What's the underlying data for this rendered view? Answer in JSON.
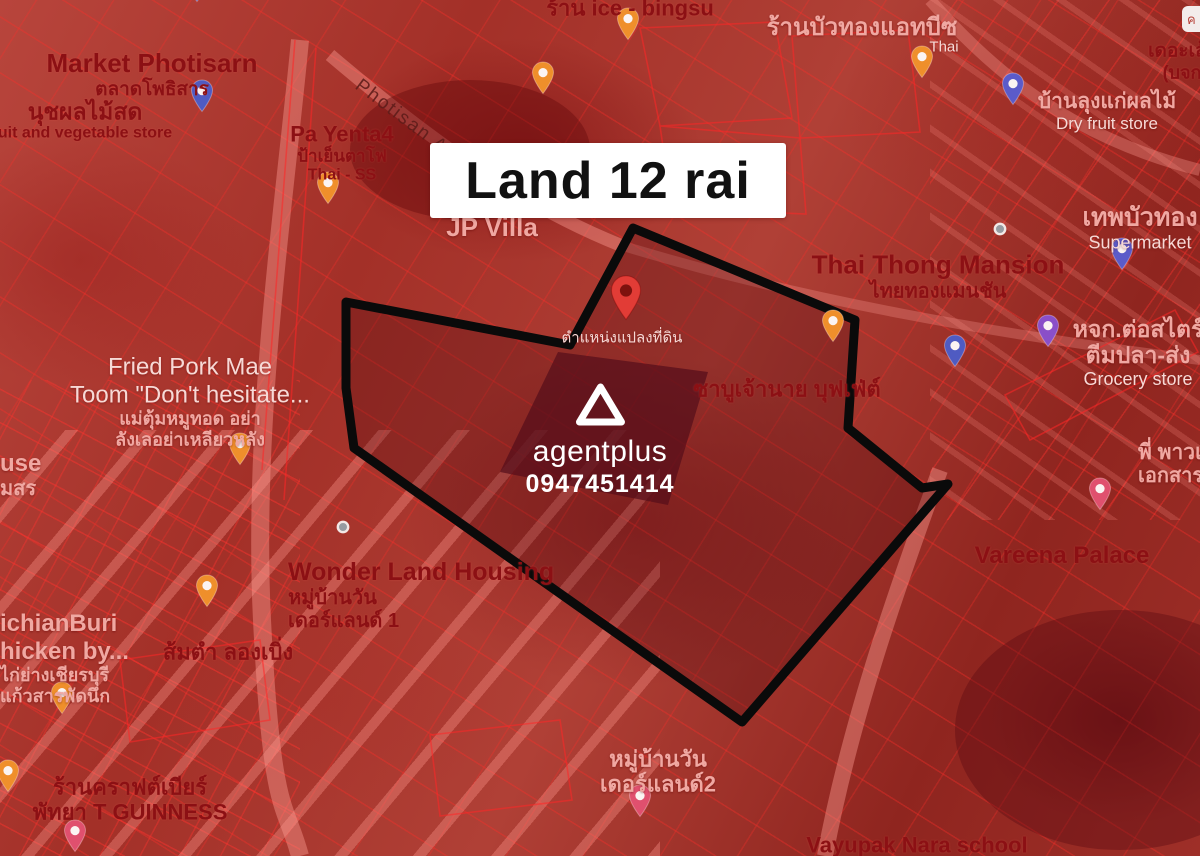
{
  "title_card": {
    "text": "Land 12 rai"
  },
  "watermark": {
    "brand": "agentplus",
    "phone": "0947451414",
    "logo": "agentplus-triangle-logo"
  },
  "corner_chip": {
    "text": "ค"
  },
  "land_plot": {
    "polygon_points": "633,228 855,320 848,428 922,488 948,484 742,722 354,448 346,388 346,302 570,345",
    "boundary_color": "#0a0a0a",
    "pin": {
      "x": 626,
      "y": 322,
      "color": "#e23c36"
    }
  },
  "colors": {
    "map_tint": "#a33028",
    "parcel_line": "#ff2a2a",
    "card_bg": "#ffffff",
    "card_text": "#111111",
    "label_dark": "#8c1014",
    "label_light": "#f0a8a2",
    "pin_orange": "#ef8f2b",
    "pin_blue": "#4f5bc2",
    "pin_violet": "#8a4fc8",
    "pin_pink": "#e0506e",
    "pin_red": "#e23c36"
  },
  "places": [
    {
      "id": "market-photisarn",
      "x": 152,
      "y": 75,
      "align": "center",
      "lines": [
        {
          "text": "Market Photisarn",
          "size": 26,
          "style": "dark"
        },
        {
          "text": "ตลาดโพธิสาร",
          "size": 19,
          "style": "dark"
        }
      ]
    },
    {
      "id": "nuch-fruit-store",
      "x": 85,
      "y": 121,
      "align": "center",
      "lines": [
        {
          "text": "นุชผลไม้สด",
          "size": 23,
          "style": "dark"
        },
        {
          "text": "uit and vegetable store",
          "size": 16,
          "style": "dark"
        }
      ]
    },
    {
      "id": "ice-bingsu",
      "x": 630,
      "y": 8,
      "align": "center",
      "lines": [
        {
          "text": "ร้าน ice - bingsu",
          "size": 22,
          "style": "dark"
        }
      ]
    },
    {
      "id": "buathong-at-b",
      "x": 862,
      "y": 28,
      "align": "center",
      "lines": [
        {
          "text": "ร้านบัวทองแอทบีซ",
          "size": 24,
          "style": "light"
        }
      ]
    },
    {
      "id": "buathong-thai",
      "x": 944,
      "y": 47,
      "align": "center",
      "lines": [
        {
          "text": "Thai",
          "size": 15,
          "style": "white"
        }
      ]
    },
    {
      "id": "the-leng",
      "x": 1182,
      "y": 62,
      "align": "center",
      "lines": [
        {
          "text": "เดอะเล้ง",
          "size": 19,
          "style": "dark"
        },
        {
          "text": "(บจก",
          "size": 18,
          "style": "dark"
        }
      ]
    },
    {
      "id": "dry-fruit-store",
      "x": 1107,
      "y": 112,
      "align": "center",
      "lines": [
        {
          "text": "บ้านลุงแก่ผลไม้",
          "size": 21,
          "style": "light"
        },
        {
          "text": "Dry fruit store",
          "size": 17,
          "style": "white"
        }
      ]
    },
    {
      "id": "pa-yenta4",
      "x": 342,
      "y": 153,
      "align": "center",
      "lines": [
        {
          "text": "Pa Yenta4",
          "size": 22,
          "style": "dark"
        },
        {
          "text": "ป้าเย็นตาโฟ",
          "size": 17,
          "style": "dark"
        },
        {
          "text": "Thai - SS",
          "size": 16,
          "style": "dark"
        }
      ]
    },
    {
      "id": "photisan-alley",
      "x": 416,
      "y": 128,
      "align": "center",
      "rotate": 37,
      "lines": [
        {
          "text": "Photisan Alley",
          "size": 19,
          "style": "street"
        }
      ]
    },
    {
      "id": "jp-villa",
      "x": 492,
      "y": 228,
      "align": "center",
      "lines": [
        {
          "text": "JP Villa",
          "size": 26,
          "style": "light"
        }
      ]
    },
    {
      "id": "thai-thong-mansion",
      "x": 938,
      "y": 277,
      "align": "center",
      "lines": [
        {
          "text": "Thai Thong Mansion",
          "size": 26,
          "style": "dark"
        },
        {
          "text": "ไทยทองแมนชัน",
          "size": 20,
          "style": "dark"
        }
      ]
    },
    {
      "id": "thep-buathong",
      "x": 1140,
      "y": 228,
      "align": "center",
      "lines": [
        {
          "text": "เทพบัวทอง",
          "size": 25,
          "style": "light"
        },
        {
          "text": "Supermarket",
          "size": 18,
          "style": "white"
        }
      ]
    },
    {
      "id": "grocery-store",
      "x": 1138,
      "y": 353,
      "align": "center",
      "lines": [
        {
          "text": "หจก.ต่อสไตร์",
          "size": 23,
          "style": "light"
        },
        {
          "text": "ตีมปลา-ส่ง",
          "size": 23,
          "style": "light"
        },
        {
          "text": "Grocery store",
          "size": 18,
          "style": "white"
        }
      ]
    },
    {
      "id": "fried-pork-mae-toom",
      "x": 190,
      "y": 402,
      "align": "center",
      "lines": [
        {
          "text": "Fried Pork Mae",
          "size": 24,
          "style": "white"
        },
        {
          "text": "Toom \"Don't hesitate...",
          "size": 24,
          "style": "white"
        },
        {
          "text": "แม่ตุ้มหมูทอด อย่า",
          "size": 18,
          "style": "light"
        },
        {
          "text": "ลังเลอย่าเหลียวหลัง",
          "size": 18,
          "style": "light"
        }
      ]
    },
    {
      "id": "shabu-chaonai-buffet",
      "x": 787,
      "y": 389,
      "align": "center",
      "lines": [
        {
          "text": "ซาบูเจ้านาย บุฟเฟ่ต์",
          "size": 22,
          "style": "dark"
        }
      ]
    },
    {
      "id": "plot-position-label",
      "x": 622,
      "y": 338,
      "align": "center",
      "lines": [
        {
          "text": "ตำแหน่งแปลงที่ดิน",
          "size": 15,
          "style": "white"
        }
      ]
    },
    {
      "id": "use-msr",
      "x": 0,
      "y": 450,
      "align": "left",
      "lines": [
        {
          "text": "use",
          "size": 24,
          "style": "light"
        },
        {
          "text": "มสร",
          "size": 20,
          "style": "light"
        }
      ]
    },
    {
      "id": "wonder-land-housing",
      "x": 288,
      "y": 558,
      "align": "left",
      "lines": [
        {
          "text": "Wonder Land Housing",
          "size": 25,
          "style": "dark"
        },
        {
          "text": "หมู่บ้านวัน",
          "size": 20,
          "style": "dark"
        },
        {
          "text": "เดอร์แลนด์ 1",
          "size": 20,
          "style": "dark"
        }
      ]
    },
    {
      "id": "somtam-longboeng",
      "x": 228,
      "y": 652,
      "align": "center",
      "lines": [
        {
          "text": "ส้มตำ ลองเบิ่ง",
          "size": 22,
          "style": "dark"
        }
      ]
    },
    {
      "id": "wichianburi-chicken",
      "x": 0,
      "y": 610,
      "align": "left",
      "lines": [
        {
          "text": "ichianBuri",
          "size": 24,
          "style": "light"
        },
        {
          "text": "hicken by...",
          "size": 24,
          "style": "light"
        },
        {
          "text": "ไก่ย่างเชียรบุรี",
          "size": 18,
          "style": "light"
        },
        {
          "text": "แก้วสารพัดนึก",
          "size": 18,
          "style": "light"
        }
      ]
    },
    {
      "id": "p-power-documents",
      "x": 1138,
      "y": 441,
      "align": "left",
      "lines": [
        {
          "text": "พี่ พาวเ",
          "size": 21,
          "style": "light"
        },
        {
          "text": "เอกสาร",
          "size": 20,
          "style": "light"
        }
      ]
    },
    {
      "id": "vareena-palace",
      "x": 1062,
      "y": 556,
      "align": "center",
      "lines": [
        {
          "text": "Vareena Palace",
          "size": 24,
          "style": "dark"
        }
      ]
    },
    {
      "id": "wonderland2",
      "x": 658,
      "y": 772,
      "align": "center",
      "lines": [
        {
          "text": "หมู่บ้านวัน",
          "size": 22,
          "style": "light"
        },
        {
          "text": "เดอร์แลนด์2",
          "size": 22,
          "style": "light"
        }
      ]
    },
    {
      "id": "craft-beer-guinness",
      "x": 130,
      "y": 800,
      "align": "center",
      "lines": [
        {
          "text": "ร้านคราฟต์เบียร์",
          "size": 22,
          "style": "dark"
        },
        {
          "text": "พัทยา T GUINNESS",
          "size": 22,
          "style": "dark"
        }
      ]
    },
    {
      "id": "vayupak-nara-school",
      "x": 917,
      "y": 845,
      "align": "center",
      "lines": [
        {
          "text": "Vayupak Nara school",
          "size": 22,
          "style": "dark"
        }
      ]
    }
  ],
  "pins": [
    {
      "id": "market-top",
      "kind": "bag",
      "color": "#4f5bc2",
      "x": 197,
      "y": 2
    },
    {
      "id": "nuch-store",
      "kind": "bag",
      "color": "#4f5bc2",
      "x": 202,
      "y": 112
    },
    {
      "id": "ice-bingsu",
      "kind": "food",
      "color": "#ef8f2b",
      "x": 628,
      "y": 40
    },
    {
      "id": "cafe",
      "kind": "food",
      "color": "#ef8f2b",
      "x": 543,
      "y": 94
    },
    {
      "id": "buathong",
      "kind": "food",
      "color": "#ef8f2b",
      "x": 922,
      "y": 78
    },
    {
      "id": "dry-fruit",
      "kind": "bag",
      "color": "#5b5bc9",
      "x": 1013,
      "y": 105
    },
    {
      "id": "pa-yenta",
      "kind": "food",
      "color": "#ef8f2b",
      "x": 328,
      "y": 204
    },
    {
      "id": "thai-thong",
      "kind": "dot",
      "color": "#969ba1",
      "x": 1000,
      "y": 229
    },
    {
      "id": "supermarket",
      "kind": "bag",
      "color": "#5b5bc9",
      "x": 1122,
      "y": 270
    },
    {
      "id": "plot-food",
      "kind": "food",
      "color": "#ef8f2b",
      "x": 833,
      "y": 342
    },
    {
      "id": "grocery-violet",
      "kind": "bag",
      "color": "#8a4fc8",
      "x": 1048,
      "y": 347
    },
    {
      "id": "grocery-bag",
      "kind": "bag",
      "color": "#4f5bc2",
      "x": 955,
      "y": 367
    },
    {
      "id": "fried-pork",
      "kind": "food",
      "color": "#ef8f2b",
      "x": 240,
      "y": 465
    },
    {
      "id": "wonder-land",
      "kind": "dot",
      "color": "#969ba1",
      "x": 343,
      "y": 527
    },
    {
      "id": "somtam",
      "kind": "food",
      "color": "#ef8f2b",
      "x": 207,
      "y": 607
    },
    {
      "id": "chicken",
      "kind": "food",
      "color": "#ef8f2b",
      "x": 62,
      "y": 714
    },
    {
      "id": "vareena",
      "kind": "pink",
      "color": "#e0506e",
      "x": 1100,
      "y": 510
    },
    {
      "id": "wonderland2",
      "kind": "pink",
      "color": "#e0506e",
      "x": 640,
      "y": 817
    },
    {
      "id": "craft-beer",
      "kind": "food",
      "color": "#ef8f2b",
      "x": 8,
      "y": 792
    },
    {
      "id": "bottom-left",
      "kind": "pink",
      "color": "#e0506e",
      "x": 75,
      "y": 852
    }
  ]
}
